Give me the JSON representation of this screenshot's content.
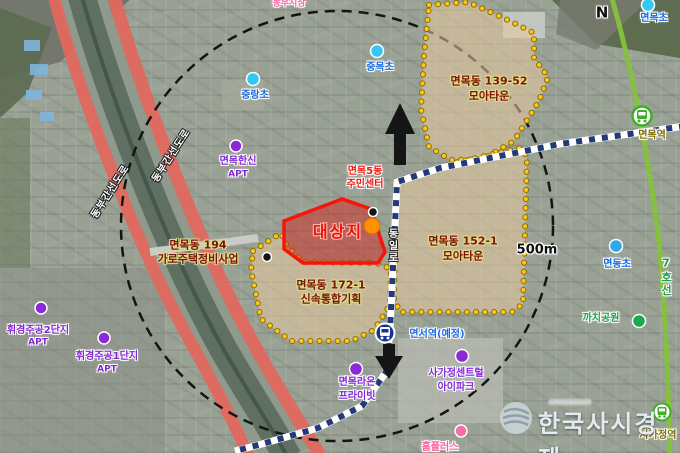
{
  "annotations": {
    "target_site": "대상지",
    "projects": {
      "p139": {
        "name": "면목동 139-52",
        "type": "모아타운"
      },
      "p152": {
        "name": "면목동 152-1",
        "type": "모아타운"
      },
      "p172": {
        "name": "면목동 172-1",
        "type": "신속통합기획"
      },
      "p194": {
        "name": "면목동 194",
        "type": "가로주택정비사업"
      }
    },
    "places": {
      "dongbu_market": "동부시장",
      "jungnang_elem": "중랑초",
      "jungmok_elem": "중목초",
      "myeonmok_elem": "면목초",
      "myeondong_elem": "면동초",
      "hanshin_apt": {
        "line1": "면목한신",
        "line2": "APT"
      },
      "hwigyeong2_apt": {
        "line1": "휘경주공2단지",
        "line2": "APT"
      },
      "hwigyeong1_apt": {
        "line1": "휘경주공1단지",
        "line2": "APT"
      },
      "raon_private": {
        "line1": "면목라온",
        "line2": "프라이빗"
      },
      "sagajeong_central": {
        "line1": "사가정센트럴",
        "line2": "아이파크"
      },
      "homeplus": "홈플러스",
      "kkachi_park": "까치공원",
      "community_center": {
        "line1": "면목5동",
        "line2": "주민센터"
      }
    },
    "stations": {
      "myeonmok": "면목역",
      "sagajeong": "사가정역",
      "myeonseo_planned": "면서역(예정)"
    },
    "roads": {
      "dongilro": "동일로",
      "dongbu_expressway": "동부간선도로",
      "line7": "7호선"
    },
    "scale": "500m",
    "compass": "N",
    "watermark": "한국사시경제"
  },
  "colors": {
    "target_red": "#f5150c",
    "moatown_dot_yellow": "#ffc61a",
    "moatown_fill_tan": "rgba(231,203,158,0.55)",
    "metro_planned_navy": "#223a77",
    "subway_line7_green": "#86c13c",
    "expressway_red": "#e0685e",
    "school_marker_cyan": "#33c7f2",
    "apt_marker_purple": "#8a2ad6",
    "park_marker_green": "#1ea84e",
    "retail_marker_pink": "#f76ea8"
  }
}
